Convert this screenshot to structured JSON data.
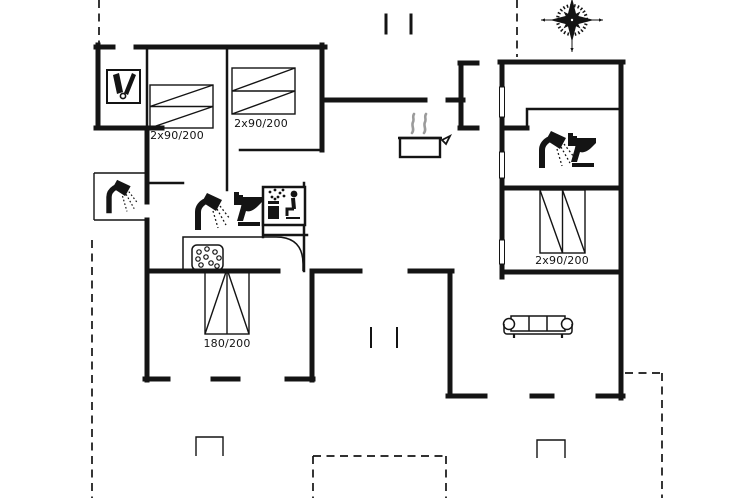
{
  "document": {
    "type": "holiday-home-floor-plan",
    "background": "#ffffff"
  },
  "colors": {
    "ink": "#141414",
    "steam_gray": "#9b9b9b",
    "background": "#ffffff"
  },
  "bed_labels": {
    "annex_bedroom": "2x90/200",
    "middle_bedroom": "2x90/200",
    "right_bedroom": "2x90/200",
    "south_bedroom": "180/200"
  },
  "fixtures": [
    {
      "name": "compass-rose-icon"
    },
    {
      "name": "washroom-icon"
    },
    {
      "name": "outdoor-shower-icon"
    },
    {
      "name": "shower-icon-bathroom-1"
    },
    {
      "name": "toilet-icon-bathroom-1"
    },
    {
      "name": "sauna-icon"
    },
    {
      "name": "whirlpool-icon"
    },
    {
      "name": "stove-icon"
    },
    {
      "name": "shower-icon-bathroom-2"
    },
    {
      "name": "toilet-icon-bathroom-2"
    },
    {
      "name": "sofa-icon"
    },
    {
      "name": "entrance-steps"
    },
    {
      "name": "terrace-dashed-outline"
    }
  ]
}
